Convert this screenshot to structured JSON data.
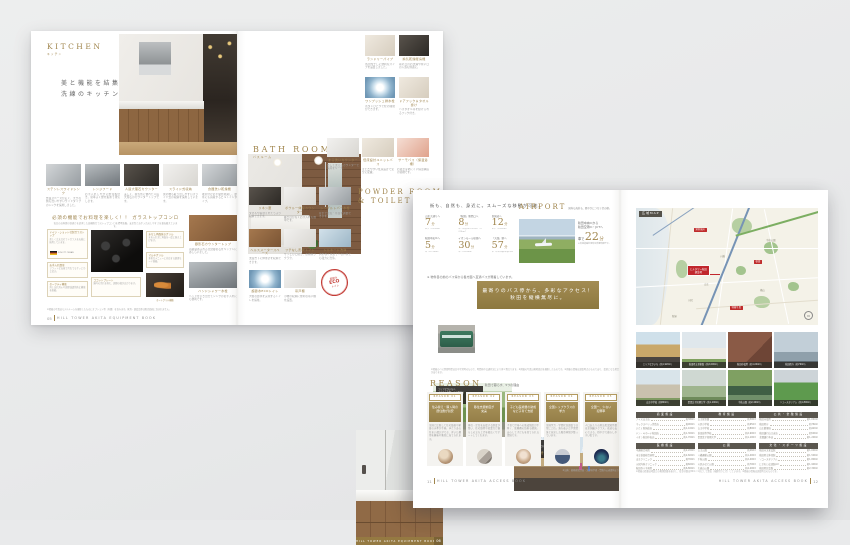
{
  "colors": {
    "gold": "#a0854c",
    "banner_gold": "#97814a",
    "dark_bar": "#3c3933",
    "map_red": "#bf2b2b",
    "stamp_red": "#c33b35",
    "page_bg": "#e9eaeb"
  },
  "s1": {
    "left": {
      "title": "KITCHEN",
      "subtitle": "キッチン",
      "lead1": "美と機能を結集した",
      "lead2": "洗練のキッチン。",
      "tiles": [
        {
          "c": "ステンレスワイドシンク",
          "b": "作業スペースが広く、大きな鍋も洗いやすいワイドタイプのシンクを採用しました。"
        },
        {
          "c": "レンジフード",
          "b": "お手入れしやすい整流板付き。効率よく煙を集めて排気します。"
        },
        {
          "c": "人造大理石カウンター",
          "b": "美しく、耐久性に優れた人造大理石のカウンタートップです。"
        },
        {
          "c": "スライド式収納",
          "b": "奥の物も取り出しやすいスライド式の収納を採用しています。"
        },
        {
          "c": "食器洗い乾燥機",
          "b": "後片付けの手間を軽減し、節水にも貢献するビルトインタイプ。"
        }
      ],
      "stove": {
        "heading": "必須の機能でお料理を楽しく！！ ガラストップコンロ",
        "sub": "毎日のお料理の快適さを追求した高機能ガラストップコンロを標準装備。安全性とお手入れのしやすさを兼ね備えています。",
        "co": [
          {
            "t": "ドイツ・ショット社製ガラストップ",
            "b": "美しく丈夫なセランガラスを天板に採用しています。"
          },
          {
            "t": "お手入れ簡単",
            "b": "フラットな天板で汚れてもサッとひと拭き。"
          },
          {
            "t": "セーフティ機能",
            "b": "消し忘れ消火や調理油過熱防止機能を搭載。"
          },
          {
            "t": "水なし両面焼きグリル",
            "b": "水を入れずに両面を一度に焼き上げます。"
          },
          {
            "t": "マルチグリル",
            "b": "多彩なメニューに対応する調理モード搭載。"
          },
          {
            "t": "ココットプレート",
            "b": "庫内の汚れを抑え、調理の幅が広がります。"
          }
        ],
        "flag": "SCHOTT CERAN",
        "fishcap": "オートグリル機能"
      },
      "side": [
        {
          "c": "御影石カウンタートップ",
          "b": "高級感あふれる天然御影石をキッチンにあしらいました。"
        },
        {
          "c": "ハンドシャワー水栓",
          "b": "ヘッドを引き出せてシンクのお手入れにも便利です。"
        }
      ],
      "note": "※掲載の写真はモデルルームを撮影したものにオプション等（有償）を含みます。家具・調度品等は販売価格に含まれません。",
      "page": "05",
      "book": "HILL TOWER AKITA EQUIPMENT BOOK"
    },
    "right": {
      "bath_title": "BATH ROOM",
      "bath_subtitle": "バスルーム",
      "bt": [
        {
          "c": "ランドリーパイプ",
          "b": "浴室内干しに便利なパイプを設置しました。"
        },
        {
          "c": "換気乾燥暖房機",
          "b": "雨の日のお洗濯や寒い日の入浴も快適に。"
        },
        {
          "c": "ワンプッシュ排水栓",
          "b": "ボタンひとつで栓の開閉ができます。"
        },
        {
          "c": "ドアフック＆タオル掛け",
          "b": "バスタオル等を掛けられるフック付き。"
        }
      ],
      "bt2": [
        {
          "c": "まる洗いカウンター",
          "b": "外して洗えるカウンターで清潔をキープ。"
        },
        {
          "c": "低床設計ユニットバス",
          "b": "またぎやすい低床設計で安全に配慮。"
        },
        {
          "c": "サーモバス（保温浴槽）",
          "b": "お湯が冷めにくい保温構造の浴槽です。"
        }
      ],
      "pow_t1": "POWDER ROOM",
      "pow_t2": "& TOILET",
      "pow_sub": "パウダールーム＆トイレ",
      "pt": [
        {
          "c": "リネン庫",
          "b": "タオルや着替えをたっぷり収納できます。"
        },
        {
          "c": "ボウル一体型カウンター",
          "b": "継ぎ目がなくお手入れも簡単です。"
        },
        {
          "c": "シングルレバー水栓",
          "b": "片手で温度・水量を調節できます。"
        },
        {
          "c": "ヘルスメータースペース",
          "b": "洗面台下に体重計を収納できます。"
        },
        {
          "c": "フチなし形状トイレ",
          "b": "サッとひと拭き、お掃除ラクラク。"
        },
        {
          "c": "トルネード洗浄",
          "b": "渦を巻く水流で少ない水でも強力に洗浄。"
        },
        {
          "c": "超節水ECOトイレ",
          "b": "大幅な節水を実現するトイレを採用。"
        },
        {
          "c": "吊戸棚",
          "b": "小物の収納に便利な吊戸棚を設置。"
        }
      ],
      "stamp1": "超節水",
      "stamp2": "ECO",
      "stamp3": "トイレ",
      "bar_name": "HILL TOWER AKITA EQUIPMENT BOOK",
      "bar_page": "06"
    }
  },
  "s2": {
    "left": {
      "headline": "街も、自然も、身近に。スムーズな移動が可能。",
      "stats": [
        {
          "d": "山王大通りへ",
          "v": "7",
          "u": "分",
          "n": "徒歩（約530m）"
        },
        {
          "d": "「秋田」駅西口へ",
          "v": "8",
          "u": "分",
          "n": "車（県道26号線利用・約2.9km）"
        },
        {
          "d": "新国道へ",
          "v": "12",
          "u": "分",
          "n": "徒歩（約950m）"
        },
        {
          "d": "秋田中央ICへ",
          "v": "5",
          "u": "分",
          "n": "車（約1.8km）"
        },
        {
          "d": "イオンモール秋田へ",
          "v": "30",
          "u": "分",
          "n": "車（約9.8km）"
        },
        {
          "d": "「大曲」駅へ",
          "v": "57",
          "u": "分",
          "n": "車（秋田自動車道利用）"
        }
      ],
      "air_t": "AIRPORT",
      "air_sub": "国内も海外も、軽やかにつなぐ空の便。",
      "air_r1": "秋田中央ICから",
      "air_r2": "秋田空港IC・JCTへ",
      "air_p": "車で",
      "air_v": "22",
      "air_u": "分",
      "air_n": "※高速道路利用時の所要時間です。",
      "busnote": "※ 物件目の前のバス停から各方面へ直通バスが発着しています。",
      "ban1": "最寄りのバス停から、多彩なアクセス！",
      "ban2": "秋田を縦横無尽に。",
      "ap": [
        {
          "l1": "エリアなかいちへ",
          "l2": "「山王十字路」バス停から",
          "p": "バスで",
          "v": "21",
          "u": "分"
        },
        {
          "l1": "イオンモール秋田へ",
          "l2": "「山王十字路」バス停から",
          "p": "バスで",
          "v": "29",
          "u": "分"
        }
      ],
      "fine": "※掲載のバス所要時間は日中平常時のもので、時間帯や交通状況により多少異なります。※掲載の写真は現地周辺を撮影したものです。※掲載の情報は調査時点のものであり、変更となる場合があります。",
      "r_title": "REASON",
      "r_sub": "秋田で暮らす、5つの理由",
      "rs": [
        {
          "num": "REASON 01",
          "h": "住み替え・購入時の\n居住費が割安",
          "b": "全国と比較して住宅価格や家賃の水準が手頃。ゆとりある住まい選びができ、浮いた費用を趣味や教育に充てられます。"
        },
        {
          "num": "REASON 02",
          "h": "移住支援制度が\n充実",
          "b": "移住・定住を支援する制度が整い、住宅取得や就業など暮らしの立ち上げを幅広くサポートしてくれます。"
        },
        {
          "num": "REASON 03",
          "h": "子ども医療費の助成\nなど子育て支援",
          "b": "子育て世帯への助成制度が手厚く、医療費の負担も軽減。安心して子どもを育てられる環境です。"
        },
        {
          "num": "REASON 04",
          "h": "全国トップクラスの\n学力",
          "b": "全国学力・学習状況調査では常に上位。落ち着いた学習環境と充実した教育体制が整っています。"
        },
        {
          "num": "REASON 05",
          "h": "全国一、少ない\n犯罪率",
          "b": "人口あたりの刑法犯認知件数は全国最少クラス。夜道も安心できる、穏やかで暮らしやすい街です。"
        }
      ],
      "r_note": "※出典：総務省統計局・文部科学省・警察庁公表資料より",
      "page": "11",
      "book": "HILL TOWER AKITA ACCESS BOOK"
    },
    "right": {
      "map_label": "広域MAP",
      "map": {
        "prop1": "ヒルタワー秋田",
        "prop2": "建設地",
        "st": [
          "泉外旭川",
          "秋田",
          "羽後牛島"
        ],
        "areas": [
          "千秋公園",
          "八橋",
          "山王",
          "楢山",
          "川尻",
          "新屋"
        ],
        "compass": "N"
      },
      "ph": [
        {
          "cap": "エリアなかいち（約1,920m）"
        },
        {
          "cap": "秋田県立美術館（約2,000m）"
        },
        {
          "cap": "秋田市役所（約1,040m）"
        },
        {
          "cap": "秋田県庁（約760m）"
        },
        {
          "cap": "山王中学校（約800m）"
        },
        {
          "cap": "聖霊女子短期大学（約1,100m）"
        },
        {
          "cap": "千秋公園（約2,400m）"
        },
        {
          "cap": "ソユースタジアム（約1,800m）"
        }
      ],
      "tb": [
        {
          "h": "商業施設",
          "rows": [
            [
              "ナイス山王店",
              "約380m"
            ],
            [
              "マックスバリュ茨島店",
              "約900m"
            ],
            [
              "いとく新国道店",
              "約1,100m"
            ],
            [
              "ドン・キホーテ秋田店",
              "約1,300m"
            ],
            [
              "イオン秋田中央店",
              "約1,700m"
            ]
          ]
        },
        {
          "h": "教育施設",
          "rows": [
            [
              "山王保育園",
              "約300m"
            ],
            [
              "川尻小学校",
              "約650m"
            ],
            [
              "山王中学校",
              "約800m"
            ],
            [
              "秋田高等学校",
              "約2,900m"
            ],
            [
              "聖霊女子短期大学",
              "約1,100m"
            ]
          ]
        },
        {
          "h": "公共・金融施設",
          "rows": [
            [
              "秋田市役所",
              "約1,040m"
            ],
            [
              "秋田県庁",
              "約760m"
            ],
            [
              "山王郵便局",
              "約420m"
            ],
            [
              "秋田銀行山王支店",
              "約500m"
            ],
            [
              "北都銀行本店",
              "約1,200m"
            ]
          ]
        },
        {
          "h": "医療施設",
          "rows": [
            [
              "中通総合病院",
              "約2,200m"
            ],
            [
              "市立秋田総合病院",
              "約2,600m"
            ],
            [
              "山王クリニック",
              "約350m"
            ],
            [
              "川尻内科クリニック",
              "約600m"
            ],
            [
              "秋田赤十字病院",
              "約6,800m"
            ]
          ]
        },
        {
          "h": "公園",
          "rows": [
            [
              "山王公園",
              "約260m"
            ],
            [
              "八橋運動公園",
              "約1,400m"
            ],
            [
              "千秋公園",
              "約2,400m"
            ],
            [
              "川尻みなと公園",
              "約700m"
            ],
            [
              "大森山公園",
              "約4,200m"
            ]
          ]
        },
        {
          "h": "文化・スポーツ施設",
          "rows": [
            [
              "秋田市文化会館",
              "約1,000m"
            ],
            [
              "秋田県立体育館",
              "約1,500m"
            ],
            [
              "ソユースタジアム",
              "約1,800m"
            ],
            [
              "にぎわい交流館AU",
              "約1,900m"
            ],
            [
              "秋田県民会館",
              "約2,300m"
            ]
          ]
        }
      ],
      "fine": "※掲載の距離は地図上の概測距離を表示し、徒歩分数は80m＝1分として算出（端数切り上げ）しています。※掲載の情報は調査時点のものです。",
      "book": "HILL TOWER AKITA ACCESS BOOK",
      "page": "12"
    }
  }
}
